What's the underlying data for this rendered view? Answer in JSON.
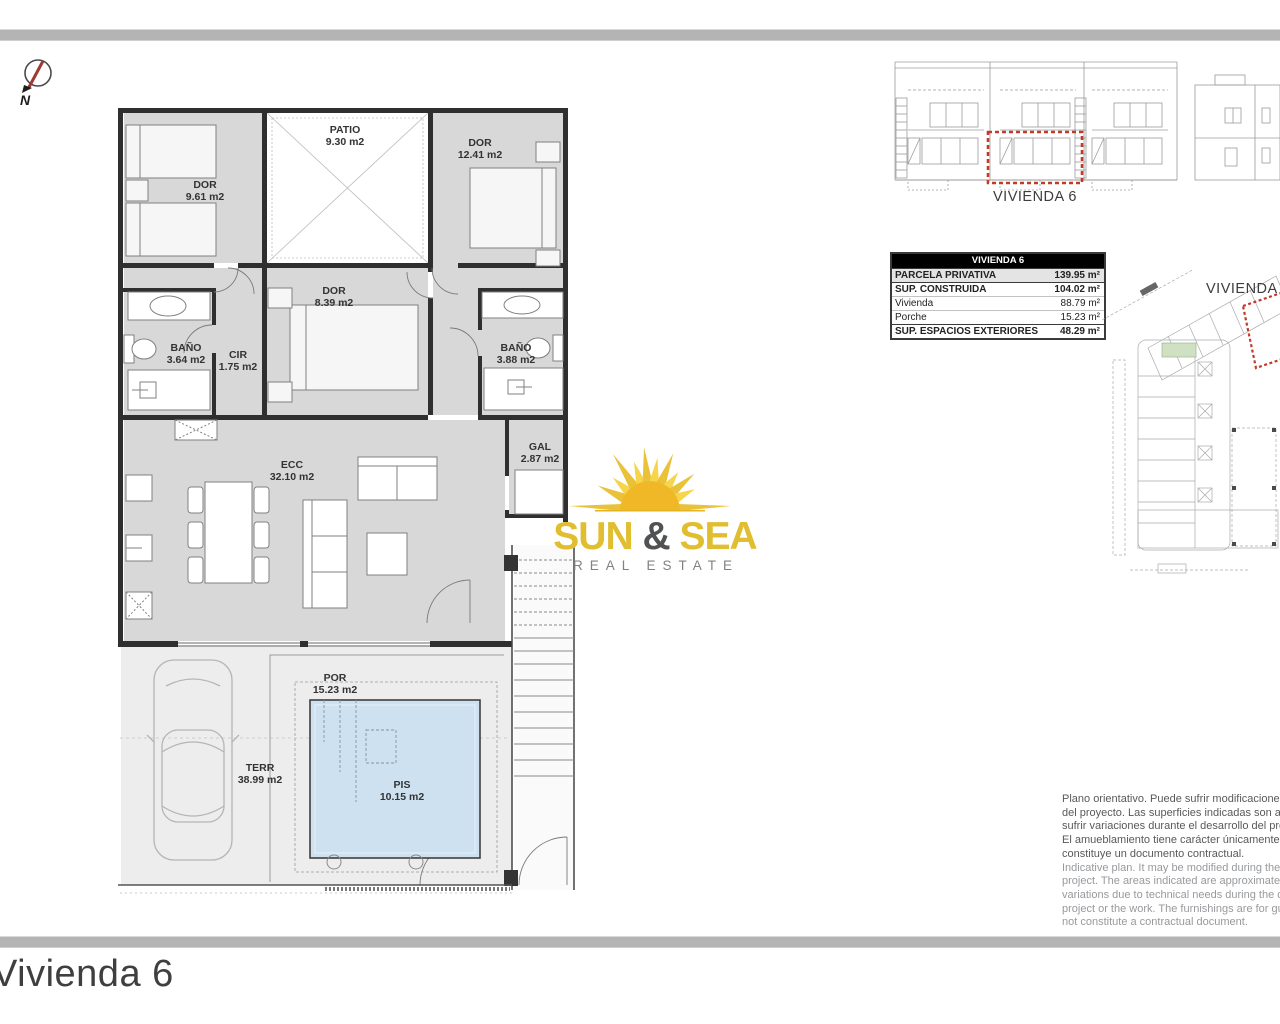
{
  "footer": {
    "title": "Vivienda 6"
  },
  "north_arrow": {
    "label": "N"
  },
  "floor_plan": {
    "rooms": [
      {
        "id": "dor1",
        "label": "DOR",
        "area": "9.61 m2"
      },
      {
        "id": "patio",
        "label": "PATIO",
        "area": "9.30 m2"
      },
      {
        "id": "dor2",
        "label": "DOR",
        "area": "12.41 m2"
      },
      {
        "id": "dor3",
        "label": "DOR",
        "area": "8.39 m2"
      },
      {
        "id": "bano1",
        "label": "BAÑO",
        "area": "3.64 m2"
      },
      {
        "id": "cir",
        "label": "CIR",
        "area": "1.75 m2"
      },
      {
        "id": "bano2",
        "label": "BAÑO",
        "area": "3.88 m2"
      },
      {
        "id": "gal",
        "label": "GAL",
        "area": "2.87 m2"
      },
      {
        "id": "ecc",
        "label": "ECC",
        "area": "32.10 m2"
      },
      {
        "id": "por",
        "label": "POR",
        "area": "15.23 m2"
      },
      {
        "id": "terr",
        "label": "TERR",
        "area": "38.99 m2"
      },
      {
        "id": "pis",
        "label": "PIS",
        "area": "10.15 m2"
      }
    ]
  },
  "elevation": {
    "label": "VIVIENDA 6"
  },
  "site_plan": {
    "label": "VIVIENDA 6"
  },
  "summary_table": {
    "header": "VIVIENDA 6",
    "rows": [
      {
        "label": "PARCELA PRIVATIVA",
        "value": "139.95 m²"
      },
      {
        "label": "SUP. CONSTRUIDA",
        "value": "104.02 m²"
      },
      {
        "label": "Vivienda",
        "value": "88.79 m²"
      },
      {
        "label": "Porche",
        "value": "15.23 m²"
      },
      {
        "label": "SUP. ESPACIOS EXTERIORES",
        "value": "48.29 m²"
      }
    ]
  },
  "logo": {
    "word1": "SUN",
    "amp": "&",
    "word2": "SEA",
    "subtitle": "REAL ESTATE"
  },
  "disclaimer": {
    "spanish": [
      "Plano orientativo. Puede sufrir modificaciones dura",
      "del proyecto. Las superficies indicadas son aproxi",
      "sufrir variaciones durante el desarrollo del proyect",
      "El amueblamiento tiene carácter únicamente orien",
      "constituye un documento contractual."
    ],
    "english": [
      "Indicative plan. It may be modified during the deve",
      "project. The areas indicated are approximate and",
      "variations due to technical needs during the devel",
      "project or the work. The furnishings are for guidan",
      "not constitute a contractual document."
    ]
  },
  "colors": {
    "accent_red": "#c43a2a",
    "room_gray": "#d8d8d8",
    "pool_blue": "#cde1f0",
    "logo_gold": "#e0be30"
  }
}
